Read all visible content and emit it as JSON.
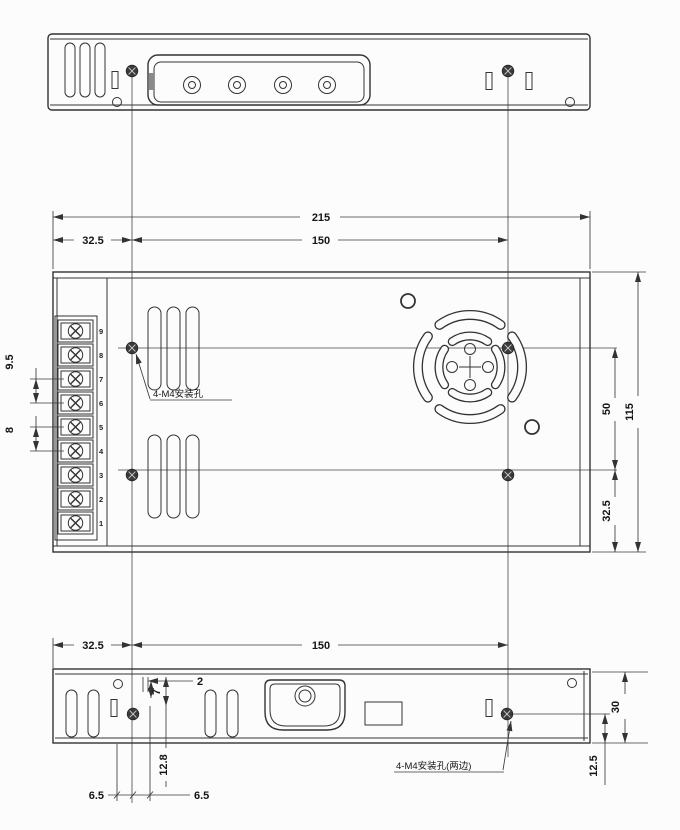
{
  "drawing": {
    "dims": {
      "overall_width": "215",
      "hole_span_x_top": "150",
      "edge_to_hole_x_top": "32.5",
      "terminal_pitch_a": "9.5",
      "terminal_pitch_b": "8",
      "hole_span_y": "50",
      "overall_depth": "115",
      "edge_to_hole_y": "32.5",
      "edge_to_hole_x_bottom": "32.5",
      "hole_span_x_bottom": "150",
      "detail_2": "2",
      "detail_7": "7",
      "detail_12_8": "12.8",
      "detail_6_5_left": "6.5",
      "detail_6_5_right": "6.5",
      "side_height": "30",
      "hole_height_from_base": "12.5"
    },
    "notes": {
      "mounting_holes": "4-M4安装孔",
      "mounting_holes_sides": "4-M4安装孔(两边)"
    },
    "terminals": [
      "9",
      "8",
      "7",
      "6",
      "5",
      "4",
      "3",
      "2",
      "1"
    ],
    "colors": {
      "line": "#333333",
      "paper": "#fcfcfc"
    }
  }
}
